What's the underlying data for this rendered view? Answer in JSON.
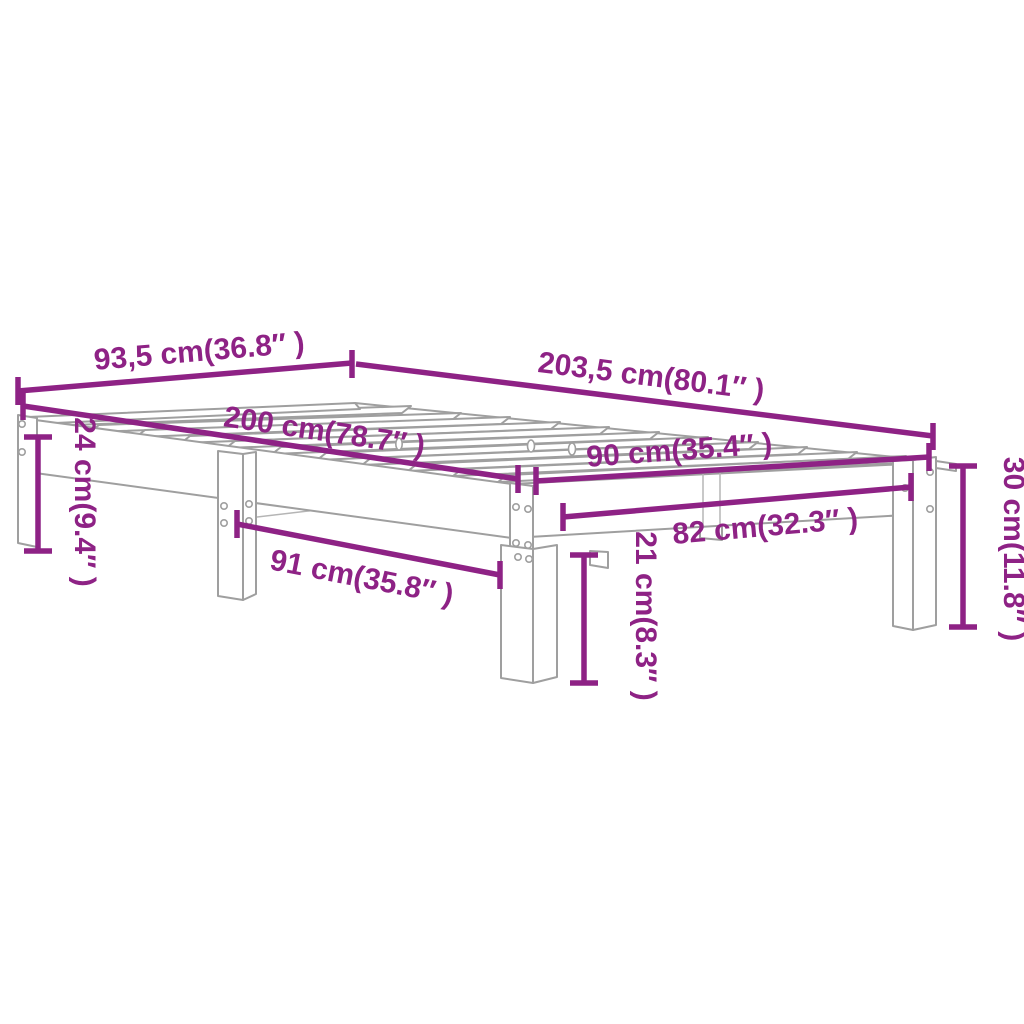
{
  "diagram": {
    "type": "product-dimension-diagram",
    "subject": "slatted bed frame",
    "colors": {
      "dimension": "#8e2285",
      "outline": "#9f9f9f",
      "outline_light": "#b5b5b5",
      "background": "#ffffff"
    },
    "dimensions": {
      "overall_width": "93,5 cm(36.8″ )",
      "overall_length": "203,5 cm(80.1″ )",
      "inner_length": "200 cm(78.7″ )",
      "inner_width": "90 cm(35.4″ )",
      "leg_span_width": "82 cm(32.3″ )",
      "leg_span_length": "91 cm(35.8″ )",
      "left_height": "24 cm(9.4″ )",
      "underbed_clearance": "21 cm(8.3″ )",
      "total_height": "30 cm(11.8″ )"
    }
  }
}
